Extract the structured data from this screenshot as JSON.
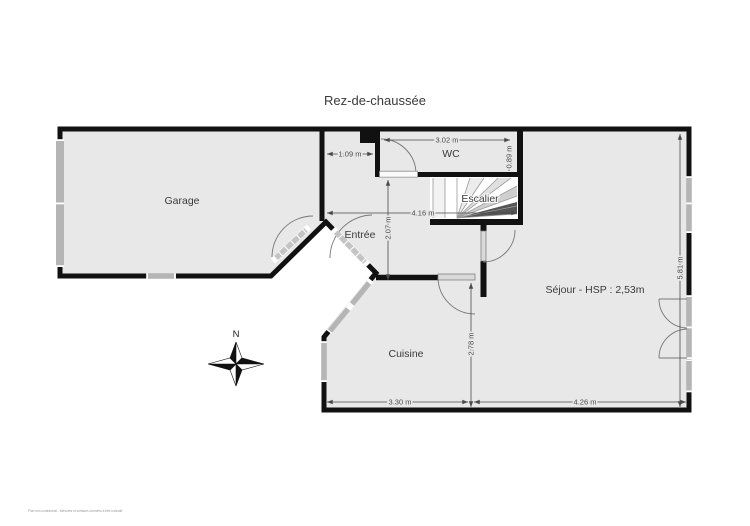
{
  "title": "Rez-de-chaussée",
  "rooms": [
    {
      "id": "garage",
      "label": "Garage"
    },
    {
      "id": "wc",
      "label": "WC"
    },
    {
      "id": "entree",
      "label": "Entrée"
    },
    {
      "id": "escalier",
      "label": "Escalier"
    },
    {
      "id": "sejour",
      "label": "Séjour - HSP : 2,53m",
      "ceiling_height": "2,53m"
    },
    {
      "id": "cuisine",
      "label": "Cuisine"
    }
  ],
  "dimensions": [
    {
      "label": "1.09 m",
      "orientation": "horizontal",
      "measures": "entry-nook-width"
    },
    {
      "label": "3.02 m",
      "orientation": "horizontal",
      "measures": "wc-width"
    },
    {
      "label": "0.89 m",
      "orientation": "vertical",
      "measures": "wc-depth"
    },
    {
      "label": "4.16 m",
      "orientation": "horizontal",
      "measures": "hall-stairs-width"
    },
    {
      "label": "2.07 m",
      "orientation": "vertical",
      "measures": "hall-depth"
    },
    {
      "label": "2.78 m",
      "orientation": "vertical",
      "measures": "cuisine-depth"
    },
    {
      "label": "3.30 m",
      "orientation": "horizontal",
      "measures": "cuisine-width"
    },
    {
      "label": "4.26 m",
      "orientation": "horizontal",
      "measures": "sejour-width"
    },
    {
      "label": "5.81 m",
      "orientation": "vertical",
      "measures": "sejour-height"
    }
  ],
  "compass": {
    "north_label": "N"
  },
  "fine_print": "Plan non contractuel - Mesures et surfaces données à titre indicatif",
  "colors": {
    "wall": "#111111",
    "floor": "#e8e8e8",
    "window": "#b5b5b5",
    "door_leaf": "#d9d9d9",
    "dimension": "#4a4a4a",
    "label_text": "#3a3a3a",
    "background": "#ffffff"
  }
}
